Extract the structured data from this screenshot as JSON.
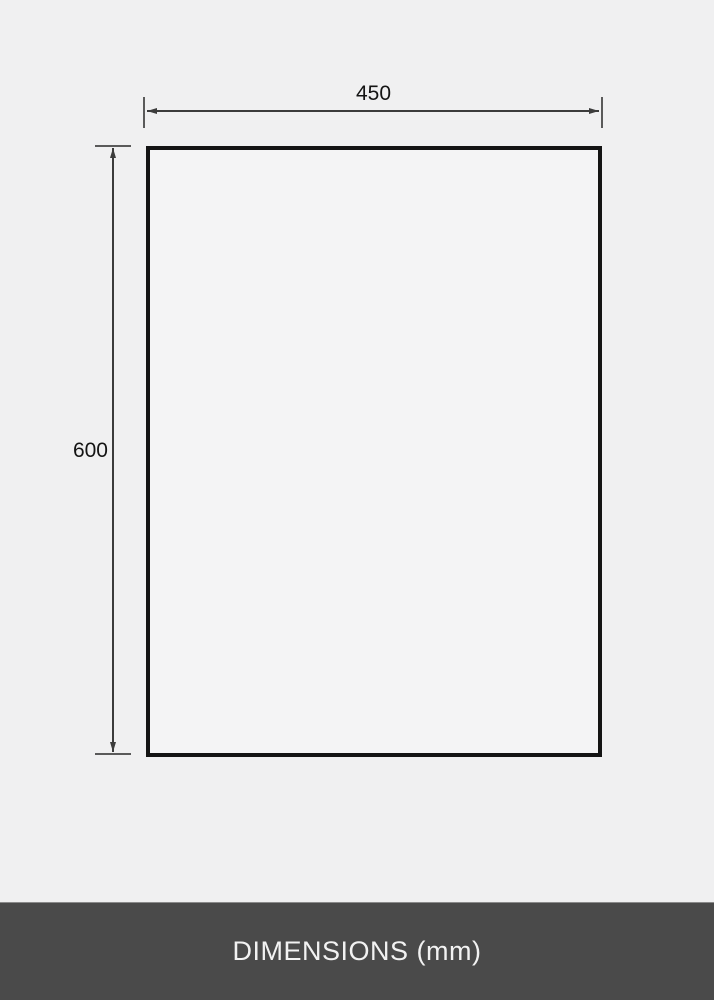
{
  "diagram": {
    "shape": "rectangle-outline",
    "width_label": "450",
    "height_label": "600",
    "unit": "mm"
  },
  "footer": {
    "title": "DIMENSIONS (mm)"
  },
  "colors": {
    "page_background": "#f0f0f1",
    "rectangle_fill": "#f4f4f5",
    "rectangle_border": "#141414",
    "dimension_line": "#3c3c3c",
    "dimension_tick": "#5a5a5a",
    "dimension_text": "#141414",
    "footer_background": "#4a4a4a",
    "footer_text": "#f2f2f2"
  }
}
